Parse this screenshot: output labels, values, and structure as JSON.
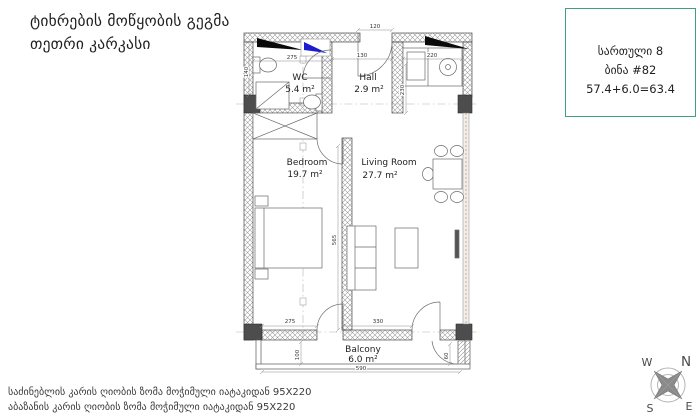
{
  "title": {
    "line1": "ტიხრების მოწყობის გეგმა",
    "line2": "თეთრი კარკასი"
  },
  "info_box": {
    "floor": "სართული 8",
    "apartment": "ბინა #82",
    "area_sum": "57.4+6.0=63.4"
  },
  "rooms": {
    "wc": {
      "name": "WC",
      "area": "5.4 m²"
    },
    "hall": {
      "name": "Hall",
      "area": "2.9 m²"
    },
    "bedroom": {
      "name": "Bedroom",
      "area": "19.7 m²"
    },
    "living": {
      "name": "Living Room",
      "area": "27.7 m²"
    },
    "balcony": {
      "name": "Balcony",
      "area": "6.0 m²"
    }
  },
  "dimensions": {
    "entrance": "120",
    "wc_width": "275",
    "hall_width": "130",
    "kitchen_width": "220",
    "left_top": "140",
    "kitchen_depth": "230",
    "partition": "565",
    "bedroom_window": "275",
    "living_window": "330",
    "balcony_depth": "100",
    "balcony_width": "590",
    "balcony_door": "60"
  },
  "footer": {
    "line1": "საძინებლის კარის ღიობის ზომა მოჭიმული იატაკიდან 95X220",
    "line2": "აბაზანის კარის ღიობის ზომა მოჭიმული იატაკიდან 95X220"
  },
  "compass": {
    "north": "N",
    "south": "S",
    "east": "E",
    "west": "W"
  },
  "colors": {
    "accent_green": "#3fa080",
    "wall_dark": "#4d4d4d",
    "marker_blue": "#1b1bd1",
    "marker_black": "#0a0a0a"
  }
}
